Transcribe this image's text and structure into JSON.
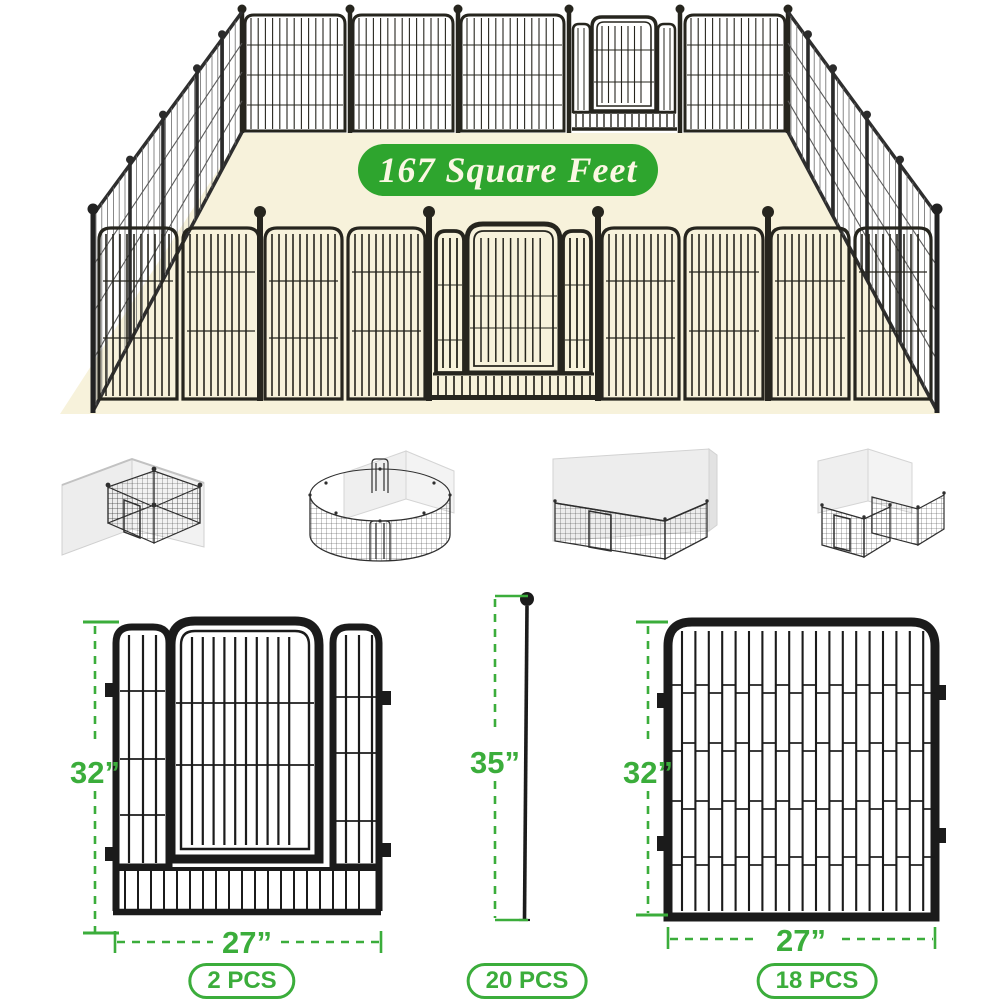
{
  "hero": {
    "area_badge": {
      "label": "167 Square Feet",
      "bg_color": "#2EA52E",
      "text_color": "#FBF7E3"
    },
    "floor_color": "#F7F2DB",
    "fence_color": "#26251E"
  },
  "configurations": [
    {
      "name": "corner-square-pen"
    },
    {
      "name": "round-pen"
    },
    {
      "name": "against-wall-pen"
    },
    {
      "name": "corner-double-pen"
    }
  ],
  "parts": {
    "accent_color": "#3BAD3B",
    "gate_panel": {
      "height_label": "32”",
      "width_label": "27”",
      "qty_label": "2 PCS"
    },
    "ground_stake": {
      "height_label": "35”",
      "qty_label": "20 PCS"
    },
    "fence_panel": {
      "height_label": "32”",
      "width_label": "27”",
      "qty_label": "18 PCS"
    }
  }
}
